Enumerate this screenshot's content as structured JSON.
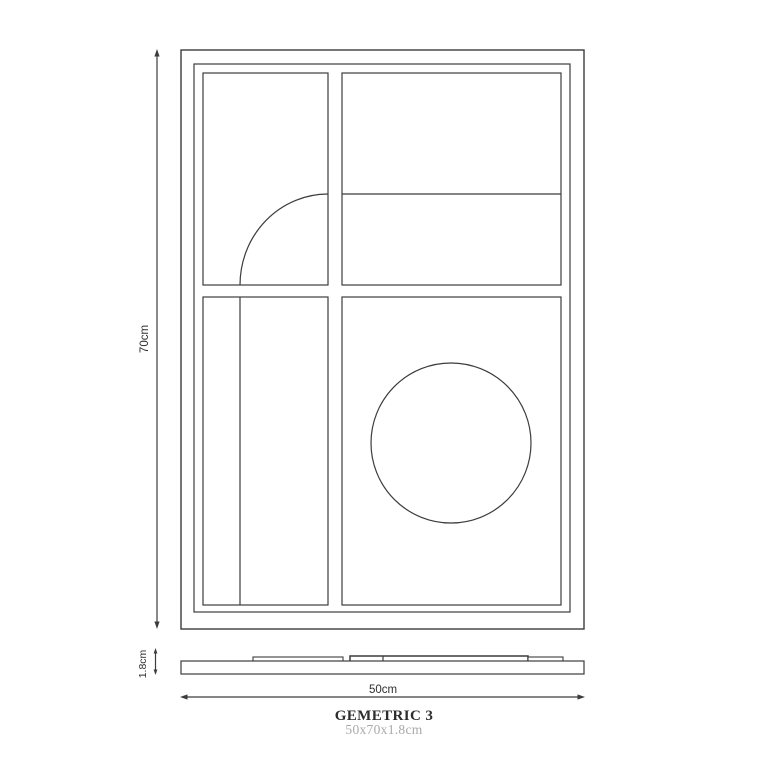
{
  "product": {
    "title": "GEMETRIC 3",
    "size": "50x70x1.8cm"
  },
  "dimensions": {
    "height": "70cm",
    "width": "50cm",
    "thickness": "1.8cm"
  },
  "colors": {
    "line": "#3c3c3c",
    "title": "#2d2d2d",
    "subtitle": "#a9a9a9",
    "background": "#ffffff"
  }
}
